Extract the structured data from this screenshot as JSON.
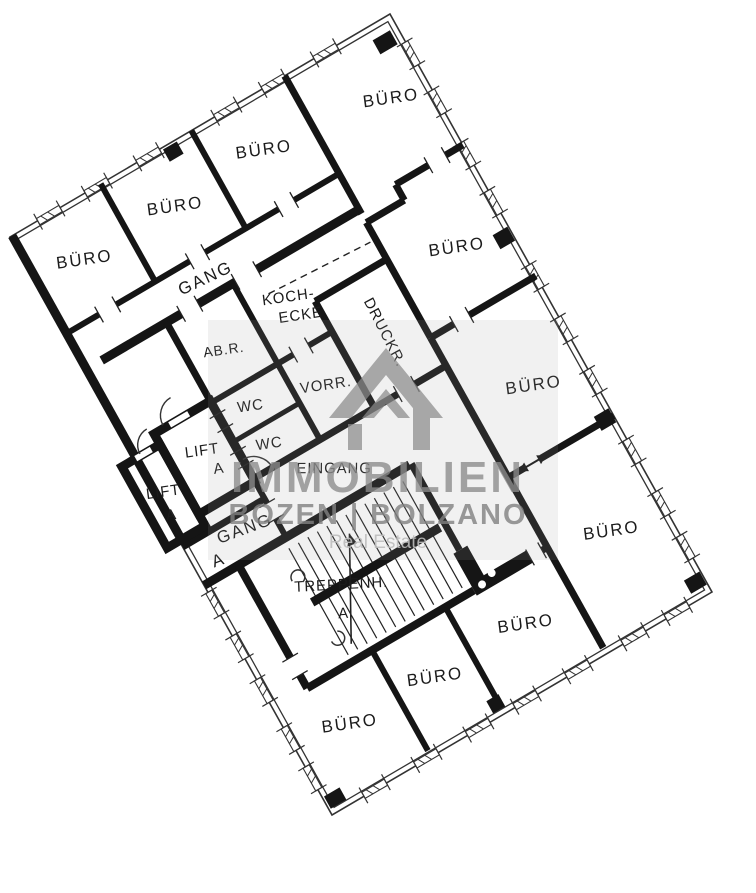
{
  "document": {
    "type": "floor-plan",
    "language": "de"
  },
  "plan_labels": {
    "offices": [
      "BÜRO",
      "BÜRO",
      "BÜRO",
      "BÜRO",
      "BÜRO",
      "BÜRO",
      "BÜRO",
      "BÜRO",
      "BÜRO",
      "BÜRO"
    ],
    "corridor_upper": "GANG",
    "corridor_lower_prefix": "A",
    "corridor_lower": "GANG",
    "kitchenette_line1": "KOCH-",
    "kitchenette_line2": "ECKE",
    "storage_room": "AB.R.",
    "anteroom": "VORR.",
    "wc1": "WC",
    "wc2": "WC",
    "printer_room": "DRUCKR.",
    "entrance": "EINGANG",
    "lift_right": "LIFT",
    "lift_right_sub": "A",
    "lift_left": "LIFT",
    "lift_left_sub": "A",
    "stairwell": "TREPPENH.",
    "stairwell_sub": "A"
  },
  "watermark": {
    "brand": "IMMOBILIEN",
    "city": "BOZEN | BOLZANO",
    "tagline": "Real Estate",
    "icon": "house-logo"
  },
  "colors": {
    "wall": "#151515",
    "background": "#ffffff",
    "watermark_gray": "#8b8b8b"
  }
}
